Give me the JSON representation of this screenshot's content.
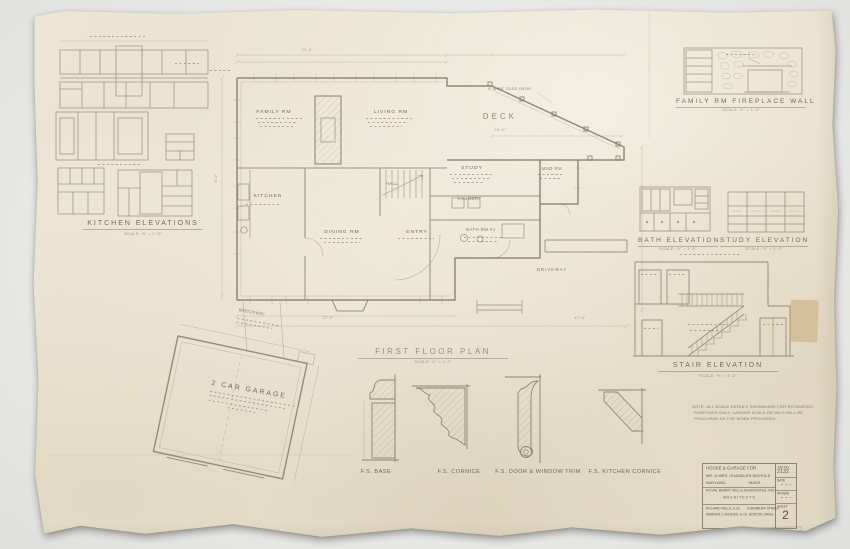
{
  "kitchen_elevations": {
    "title": "KITCHEN ELEVATIONS",
    "scale": "SCALE: ½\" = 1'-0\""
  },
  "floor_plan": {
    "title": "FIRST FLOOR PLAN",
    "scale": "SCALE: ¼\" = 1'-0\"",
    "rooms": {
      "family": "FAMILY RM",
      "living": "LIVING RM",
      "deck": "DECK",
      "kitchen": "KITCHEN",
      "dining": "DINING RM",
      "entry": "ENTRY",
      "hall": "HALL",
      "study": "STUDY",
      "laundry": "LAUNDRY",
      "bath": "BATH RM #1",
      "mud": "MUD RM",
      "driveway": "DRIVEWAY"
    },
    "patio_note": "4' WIDE TILED PATIO",
    "dims": {
      "d1": "23'-4\"",
      "d2": "16'-6\"",
      "d3": "12'-0\"",
      "d4": "47'-6\"",
      "d5": "9'-0\""
    }
  },
  "garage": {
    "title": "2 CAR GARAGE",
    "breezeway": "BREEZEWAY"
  },
  "details": {
    "base": "F.S. BASE",
    "cornice": "F.S. CORNICE",
    "door_trim": "F.S. DOOR & WINDOW TRIM",
    "kitchen_cornice": "F.S. KITCHEN CORNICE"
  },
  "fireplace_detail": {
    "title": "FAMILY RM FIREPLACE WALL",
    "scale": "SCALE: ½\" = 1'-0\""
  },
  "bath_elevation": {
    "title": "BATH ELEVATION",
    "scale": "SCALE: ½\" = 1'-0\""
  },
  "study_elevation": {
    "title": "STUDY ELEVATION",
    "scale": "SCALE: ½\" = 1'-0\""
  },
  "stair_elevation": {
    "title": "STAIR ELEVATION",
    "scale": "SCALE: ½\" = 1'-0\""
  },
  "general_note": {
    "line1": "NOTE: ALL SCALE DETAILS SHOWN ARE FOR ESTIMATING",
    "line2": "PURPOSES ONLY. LARGER SCALE DETAILS WILL BE",
    "line3": "PROCURED AS THE WORK PROCEEDS."
  },
  "title_block": {
    "project_line1": "HOUSE & GARAGE FOR",
    "project_line2": "MR. & MRS. CHANDLER NICHOLS",
    "location_city": "WAYLAND,",
    "location_state": "MASS.",
    "firm": "ROYAL BARRY WILLS ASSOCIATES, INC",
    "firm_sub": "A R C H I T E C T S",
    "credit1": "RICHARD WILLS, A.I.A.",
    "credit2": "WARREN J. RHODES, A.I.A.",
    "address1": "8 NEWBURY STREET",
    "address2": "BOSTON, MASS.",
    "job_label": "JOB NO.",
    "job_number": "2132",
    "date_label": "DATE",
    "drawn_label": "DRAWN",
    "sheet_label": "SHEET",
    "sheet_number": "2"
  },
  "stamp": "D-600"
}
